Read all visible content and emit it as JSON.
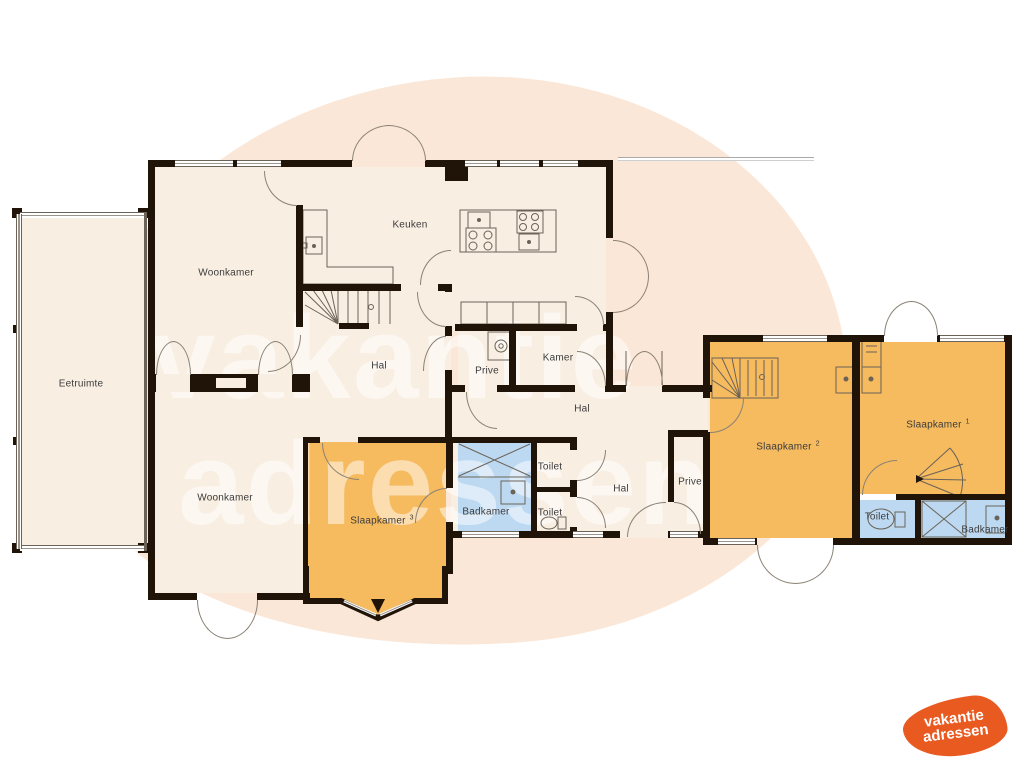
{
  "labels": {
    "eetruimte": "Eetruimte",
    "woonkamer_top": "Woonkamer",
    "woonkamer_bottom": "Woonkamer",
    "keuken": "Keuken",
    "hal_center": "Hal",
    "hal_east": "Hal",
    "hal_corridor": "Hal",
    "prive_west": "Prive",
    "prive_east": "Prive",
    "kamer": "Kamer",
    "slaapkamer1": "Slaapkamer",
    "slaapkamer1_num": "1",
    "slaapkamer2": "Slaapkamer",
    "slaapkamer2_num": "2",
    "slaapkamer3": "Slaapkamer",
    "slaapkamer3_num": "3",
    "badkamer_west": "Badkamer",
    "badkamer_east": "Badkamer",
    "toilet_top": "Toilet",
    "toilet_bottom": "Toilet",
    "toilet_east": "Toilet"
  },
  "watermark": {
    "line1": "vakantie",
    "line2": "adressen"
  },
  "logo": {
    "line1": "vakantie",
    "line2": "adressen"
  },
  "colors": {
    "floor_cream": "#f8eee2",
    "bedroom_orange": "#f6ba5f",
    "bathroom_blue": "#bdd9f2",
    "wall_dark": "#201409",
    "background_blob": "#fbe7d7",
    "logo_orange": "#e95a20"
  }
}
